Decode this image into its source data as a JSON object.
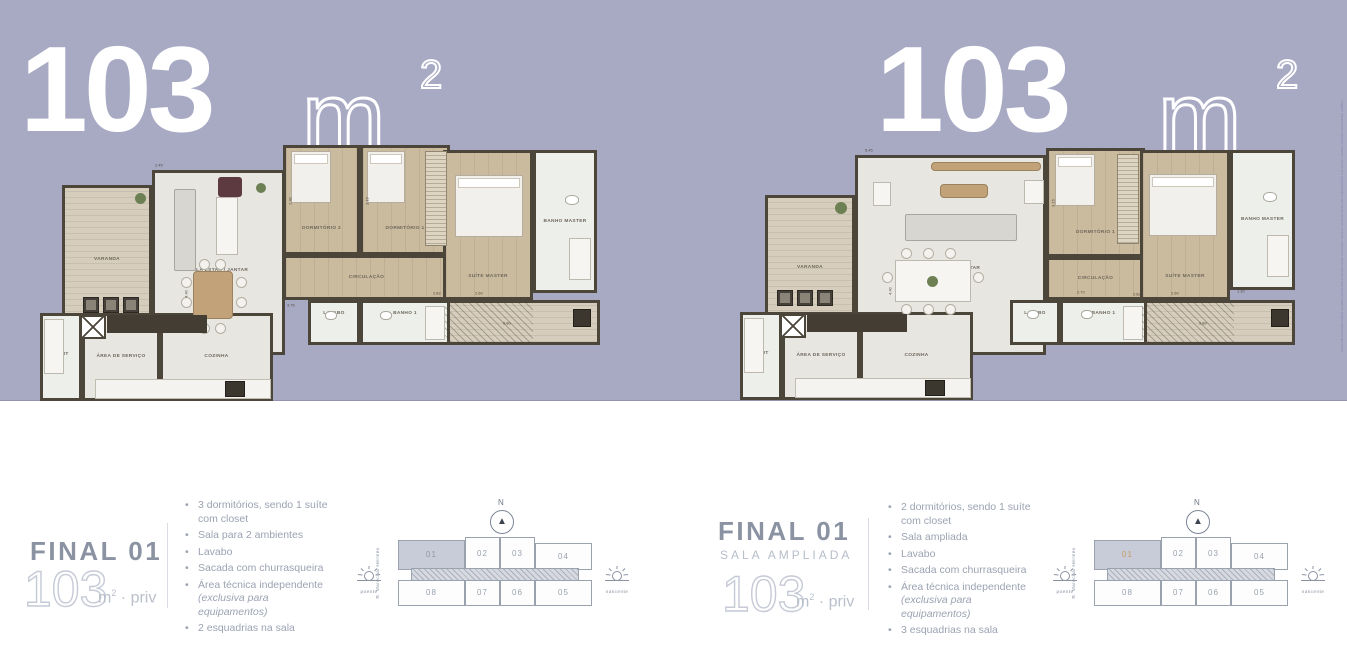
{
  "colors": {
    "background": "#a8aac4",
    "hero_text": "#ffffff",
    "detail_title": "#8b93a3",
    "bullet_text": "#9ba3b2",
    "highlight_unit_text": "#c49a62",
    "wall": "#4b453a"
  },
  "headers": [
    {
      "value": "103",
      "unit": "m",
      "sup": "2"
    },
    {
      "value": "103",
      "unit": "m",
      "sup": "2"
    }
  ],
  "plans": [
    {
      "name": "floor-plan-final-01",
      "rooms": [
        {
          "id": "varanda",
          "label": "VARANDA",
          "x": 27,
          "y": 42,
          "w": 90,
          "h": 160,
          "floor": "deck",
          "lt": 47
        },
        {
          "id": "sala-estar-jantar",
          "label": "SALA ESTAR / JANTAR",
          "x": 117,
          "y": 27,
          "w": 133,
          "h": 185,
          "floor": "light",
          "lt": 55
        },
        {
          "id": "dormitorio-2",
          "label": "DORMITÓRIO 2",
          "x": 248,
          "y": 2,
          "w": 77,
          "h": 110,
          "floor": "wood",
          "lt": 78
        },
        {
          "id": "dormitorio-1",
          "label": "DORMITÓRIO 1",
          "x": 325,
          "y": 2,
          "w": 90,
          "h": 110,
          "floor": "wood",
          "lt": 78
        },
        {
          "id": "circulacao",
          "label": "CIRCULAÇÃO",
          "x": 248,
          "y": 112,
          "w": 167,
          "h": 45,
          "floor": "wood",
          "lt": 50
        },
        {
          "id": "suite-master",
          "label": "SUÍTE MASTER",
          "x": 408,
          "y": 7,
          "w": 90,
          "h": 150,
          "floor": "wood",
          "lt": 86
        },
        {
          "id": "banho-master",
          "label": "BANHO MASTER",
          "x": 498,
          "y": 7,
          "w": 64,
          "h": 143,
          "floor": "tile",
          "lt": 50
        },
        {
          "id": "sacada",
          "label": "",
          "x": 408,
          "y": 157,
          "w": 157,
          "h": 45,
          "floor": "deck",
          "lt": 50
        },
        {
          "id": "lavabo",
          "label": "LAVABO",
          "x": 273,
          "y": 157,
          "w": 52,
          "h": 45,
          "floor": "tile",
          "lt": 28
        },
        {
          "id": "banho-1",
          "label": "BANHO 1",
          "x": 325,
          "y": 157,
          "w": 90,
          "h": 45,
          "floor": "tile",
          "lt": 28
        },
        {
          "id": "split",
          "label": "SPLIT",
          "x": 5,
          "y": 170,
          "w": 42,
          "h": 88,
          "floor": "tile",
          "lt": 48
        },
        {
          "id": "area-de-servico",
          "label": "ÁREA DE SERVIÇO",
          "x": 47,
          "y": 170,
          "w": 78,
          "h": 88,
          "floor": "light",
          "lt": 50
        },
        {
          "id": "cozinha",
          "label": "COZINHA",
          "x": 125,
          "y": 170,
          "w": 113,
          "h": 88,
          "floor": "light",
          "lt": 50
        }
      ],
      "furniture": [
        [
          "planter",
          48,
          154,
          16,
          16
        ],
        [
          "planter",
          68,
          154,
          16,
          16
        ],
        [
          "planter",
          88,
          154,
          16,
          16
        ],
        [
          "plant",
          100,
          50,
          11,
          11
        ],
        [
          "chair",
          183,
          34,
          24,
          20
        ],
        [
          "sofa",
          139,
          46,
          22,
          82
        ],
        [
          "island",
          181,
          54,
          22,
          58
        ],
        [
          "plant",
          221,
          40,
          10,
          10
        ],
        [
          "table",
          158,
          128,
          40,
          48
        ],
        [
          "dot",
          146,
          134,
          11,
          11
        ],
        [
          "dot",
          146,
          154,
          11,
          11
        ],
        [
          "dot",
          201,
          134,
          11,
          11
        ],
        [
          "dot",
          201,
          154,
          11,
          11
        ],
        [
          "dot",
          164,
          116,
          11,
          11
        ],
        [
          "dot",
          180,
          116,
          11,
          11
        ],
        [
          "dot",
          164,
          180,
          11,
          11
        ],
        [
          "dot",
          180,
          180,
          11,
          11
        ],
        [
          "bed",
          256,
          8,
          40,
          52
        ],
        [
          "bed",
          332,
          8,
          38,
          52
        ],
        [
          "shelves",
          390,
          8,
          22,
          95
        ],
        [
          "bed",
          420,
          32,
          68,
          62
        ],
        [
          "wc",
          530,
          52,
          14,
          10
        ],
        [
          "island",
          534,
          95,
          22,
          42
        ],
        [
          "wc",
          290,
          168,
          12,
          9
        ],
        [
          "wc",
          345,
          168,
          12,
          9
        ],
        [
          "island",
          390,
          163,
          20,
          34
        ],
        [
          "hatch",
          410,
          159,
          88,
          41
        ],
        [
          "grill",
          538,
          166,
          18,
          18
        ],
        [
          "xsq",
          45,
          172,
          26,
          24
        ],
        [
          "counter",
          72,
          172,
          100,
          18
        ],
        [
          "counterlight",
          60,
          236,
          176,
          20
        ],
        [
          "grill",
          190,
          238,
          20,
          16
        ],
        [
          "island",
          9,
          176,
          20,
          55
        ]
      ],
      "dims": [
        [
          "2.45",
          118,
          20,
          0
        ],
        [
          "2.40",
          250,
          55,
          -90
        ],
        [
          "3.15",
          327,
          55,
          -90
        ],
        [
          "4.40",
          146,
          148,
          -90
        ],
        [
          "3.76",
          250,
          160,
          0
        ],
        [
          "2.82",
          396,
          148,
          0
        ],
        [
          "2.60",
          438,
          148,
          0
        ],
        [
          "1.30",
          502,
          146,
          0
        ],
        [
          "5.80",
          466,
          178,
          0
        ]
      ]
    },
    {
      "name": "floor-plan-final-01-sala-ampliada",
      "rooms": [
        {
          "id": "varanda",
          "label": "VARANDA",
          "x": 30,
          "y": 55,
          "w": 90,
          "h": 155,
          "floor": "deck",
          "lt": 47
        },
        {
          "id": "sala-estar-jantar",
          "label": "SALA ESTAR / JANTAR",
          "x": 120,
          "y": 15,
          "w": 191,
          "h": 200,
          "floor": "light",
          "lt": 57
        },
        {
          "id": "dormitorio-1",
          "label": "DORMITÓRIO 1",
          "x": 311,
          "y": 8,
          "w": 99,
          "h": 109,
          "floor": "wood",
          "lt": 80
        },
        {
          "id": "circulacao",
          "label": "CIRCULAÇÃO",
          "x": 311,
          "y": 117,
          "w": 99,
          "h": 43,
          "floor": "wood",
          "lt": 50
        },
        {
          "id": "suite-master",
          "label": "SUÍTE MASTER",
          "x": 405,
          "y": 10,
          "w": 90,
          "h": 150,
          "floor": "wood",
          "lt": 86
        },
        {
          "id": "banho-master",
          "label": "BANHO MASTER",
          "x": 495,
          "y": 10,
          "w": 65,
          "h": 140,
          "floor": "tile",
          "lt": 50
        },
        {
          "id": "sacada",
          "label": "",
          "x": 405,
          "y": 160,
          "w": 155,
          "h": 45,
          "floor": "deck",
          "lt": 50
        },
        {
          "id": "lavabo",
          "label": "LAVABO",
          "x": 275,
          "y": 160,
          "w": 50,
          "h": 45,
          "floor": "tile",
          "lt": 28
        },
        {
          "id": "banho-1",
          "label": "BANHO 1",
          "x": 325,
          "y": 160,
          "w": 87,
          "h": 45,
          "floor": "tile",
          "lt": 28
        },
        {
          "id": "split",
          "label": "SPLIT",
          "x": 5,
          "y": 172,
          "w": 42,
          "h": 88,
          "floor": "tile",
          "lt": 48
        },
        {
          "id": "area-de-servico",
          "label": "ÁREA DE SERVIÇO",
          "x": 47,
          "y": 172,
          "w": 78,
          "h": 88,
          "floor": "light",
          "lt": 50
        },
        {
          "id": "cozinha",
          "label": "COZINHA",
          "x": 125,
          "y": 172,
          "w": 113,
          "h": 88,
          "floor": "light",
          "lt": 50
        }
      ],
      "furniture": [
        [
          "planter",
          42,
          150,
          16,
          16
        ],
        [
          "planter",
          62,
          150,
          16,
          16
        ],
        [
          "planter",
          82,
          150,
          16,
          16
        ],
        [
          "plant",
          100,
          62,
          12,
          12
        ],
        [
          "table",
          196,
          22,
          110,
          9
        ],
        [
          "island",
          138,
          42,
          18,
          24
        ],
        [
          "table",
          205,
          44,
          48,
          14
        ],
        [
          "sofa",
          170,
          74,
          112,
          27
        ],
        [
          "island",
          289,
          40,
          20,
          24
        ],
        [
          "island",
          160,
          120,
          76,
          42
        ],
        [
          "plant",
          192,
          136,
          11,
          11
        ],
        [
          "dot",
          166,
          108,
          11,
          11
        ],
        [
          "dot",
          188,
          108,
          11,
          11
        ],
        [
          "dot",
          210,
          108,
          11,
          11
        ],
        [
          "dot",
          166,
          164,
          11,
          11
        ],
        [
          "dot",
          188,
          164,
          11,
          11
        ],
        [
          "dot",
          210,
          164,
          11,
          11
        ],
        [
          "dot",
          147,
          132,
          11,
          11
        ],
        [
          "dot",
          238,
          132,
          11,
          11
        ],
        [
          "bed",
          320,
          14,
          40,
          52
        ],
        [
          "shelves",
          382,
          14,
          22,
          90
        ],
        [
          "bed",
          414,
          34,
          68,
          62
        ],
        [
          "wc",
          528,
          52,
          14,
          10
        ],
        [
          "island",
          532,
          95,
          22,
          42
        ],
        [
          "wc",
          292,
          170,
          12,
          9
        ],
        [
          "wc",
          346,
          170,
          12,
          9
        ],
        [
          "island",
          388,
          166,
          20,
          34
        ],
        [
          "hatch",
          407,
          162,
          92,
          41
        ],
        [
          "grill",
          536,
          169,
          18,
          18
        ],
        [
          "xsq",
          45,
          174,
          26,
          24
        ],
        [
          "counter",
          72,
          174,
          100,
          18
        ],
        [
          "counterlight",
          60,
          238,
          176,
          20
        ],
        [
          "grill",
          190,
          240,
          20,
          16
        ],
        [
          "island",
          9,
          178,
          20,
          55
        ]
      ],
      "dims": [
        [
          "5.45",
          128,
          8,
          0
        ],
        [
          "4.40",
          150,
          148,
          -90
        ],
        [
          "3.15",
          313,
          60,
          -90
        ],
        [
          "2.70",
          340,
          150,
          0
        ],
        [
          "2.82",
          396,
          152,
          0
        ],
        [
          "2.60",
          434,
          151,
          0
        ],
        [
          "1.30",
          500,
          149,
          0
        ],
        [
          "5.80",
          462,
          181,
          0
        ]
      ]
    }
  ],
  "details": [
    {
      "title": "FINAL 01",
      "area": "103",
      "area_unit": "m",
      "area_sup": "2",
      "area_suffix": "· priv",
      "bullets": [
        {
          "text": "3 dormitórios, sendo 1 suíte com closet"
        },
        {
          "text": "Sala para 2 ambientes"
        },
        {
          "text": "Lavabo"
        },
        {
          "text": "Sacada com churrasqueira"
        },
        {
          "text": "Área técnica independente",
          "note": "(exclusiva para equipamentos)"
        },
        {
          "text": "2 esquadrias na sala"
        }
      ]
    },
    {
      "title": "FINAL 01",
      "subtitle": "SALA AMPLIADA",
      "area": "103",
      "area_unit": "m",
      "area_sup": "2",
      "area_suffix": "· priv",
      "bullets": [
        {
          "text": "2 dormitórios, sendo 1 suíte com closet"
        },
        {
          "text": "Sala ampliada"
        },
        {
          "text": "Lavabo"
        },
        {
          "text": "Sacada com churrasqueira"
        },
        {
          "text": "Área técnica independente",
          "note": "(exclusiva para equipamentos)"
        },
        {
          "text": "3 esquadrias na sala"
        }
      ]
    }
  ],
  "keyplan": {
    "north_label": "N",
    "street": "R. Marechal Hermes",
    "west_label": "poente",
    "east_label": "nascente",
    "top_units": [
      "01",
      "02",
      "03",
      "04"
    ],
    "bottom_units": [
      "08",
      "07",
      "06",
      "05"
    ],
    "highlighted_unit": "01",
    "instances": [
      {
        "highlight_text_color": "#8f97a5"
      },
      {
        "highlight_text_color": "#c49a62"
      }
    ]
  },
  "disclaimer": "Imagem meramente ilustrativa. Móveis, utensílios e equipamentos não fazem parte do contrato. Medidas e áreas sujeitas a alterações conforme projeto executivo aprovado."
}
